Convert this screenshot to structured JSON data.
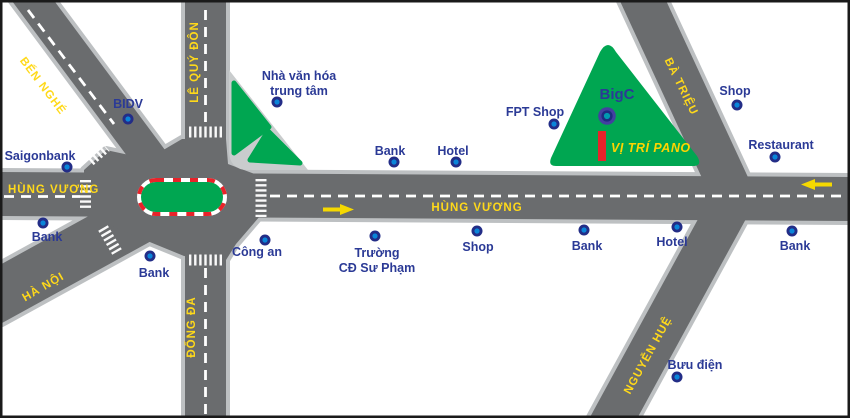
{
  "map_type": "billboard-location-street-map",
  "colors": {
    "road": "#6a6c6e",
    "road_casing": "#bdc0c2",
    "park_green": "#00a651",
    "road_label_yellow": "#ffd91a",
    "poi_label_navy": "#2b3a96",
    "billboard_red": "#e8232a",
    "dot_outer": "#232d87",
    "dot_inner": "#0a85d9",
    "background": "#ffffff"
  },
  "road_labels": {
    "hung_vuong_west": "HÙNG VƯƠNG",
    "hung_vuong_center": "HÙNG VƯƠNG",
    "ben_nghe": "BẾN NGHÉ",
    "le_quy_don": "LÊ QUÝ ĐÔN",
    "ha_noi": "HÀ NỘI",
    "dong_da": "ĐỐNG ĐA",
    "ba_trieu": "BÀ TRIỆU",
    "nguyen_hue": "NGUYỄN HUỆ"
  },
  "pois": [
    {
      "label": "BIDV"
    },
    {
      "label": "Saigonbank"
    },
    {
      "label": "Bank"
    },
    {
      "label": "Bank"
    },
    {
      "label": "Công an"
    },
    {
      "lines": [
        "Nhà văn hóa",
        "trung tâm"
      ]
    },
    {
      "lines": [
        "Trường",
        "CĐ Sư Phạm"
      ]
    },
    {
      "label": "Bank"
    },
    {
      "label": "Hotel"
    },
    {
      "label": "Shop"
    },
    {
      "label": "FPT Shop"
    },
    {
      "label": "BigC"
    },
    {
      "label": "Shop"
    },
    {
      "label": "Restaurant"
    },
    {
      "label": "Bank"
    },
    {
      "label": "Hotel"
    },
    {
      "label": "Bank"
    },
    {
      "label": "Bưu điện"
    }
  ],
  "billboard": {
    "label": "VỊ TRÍ PANO"
  }
}
